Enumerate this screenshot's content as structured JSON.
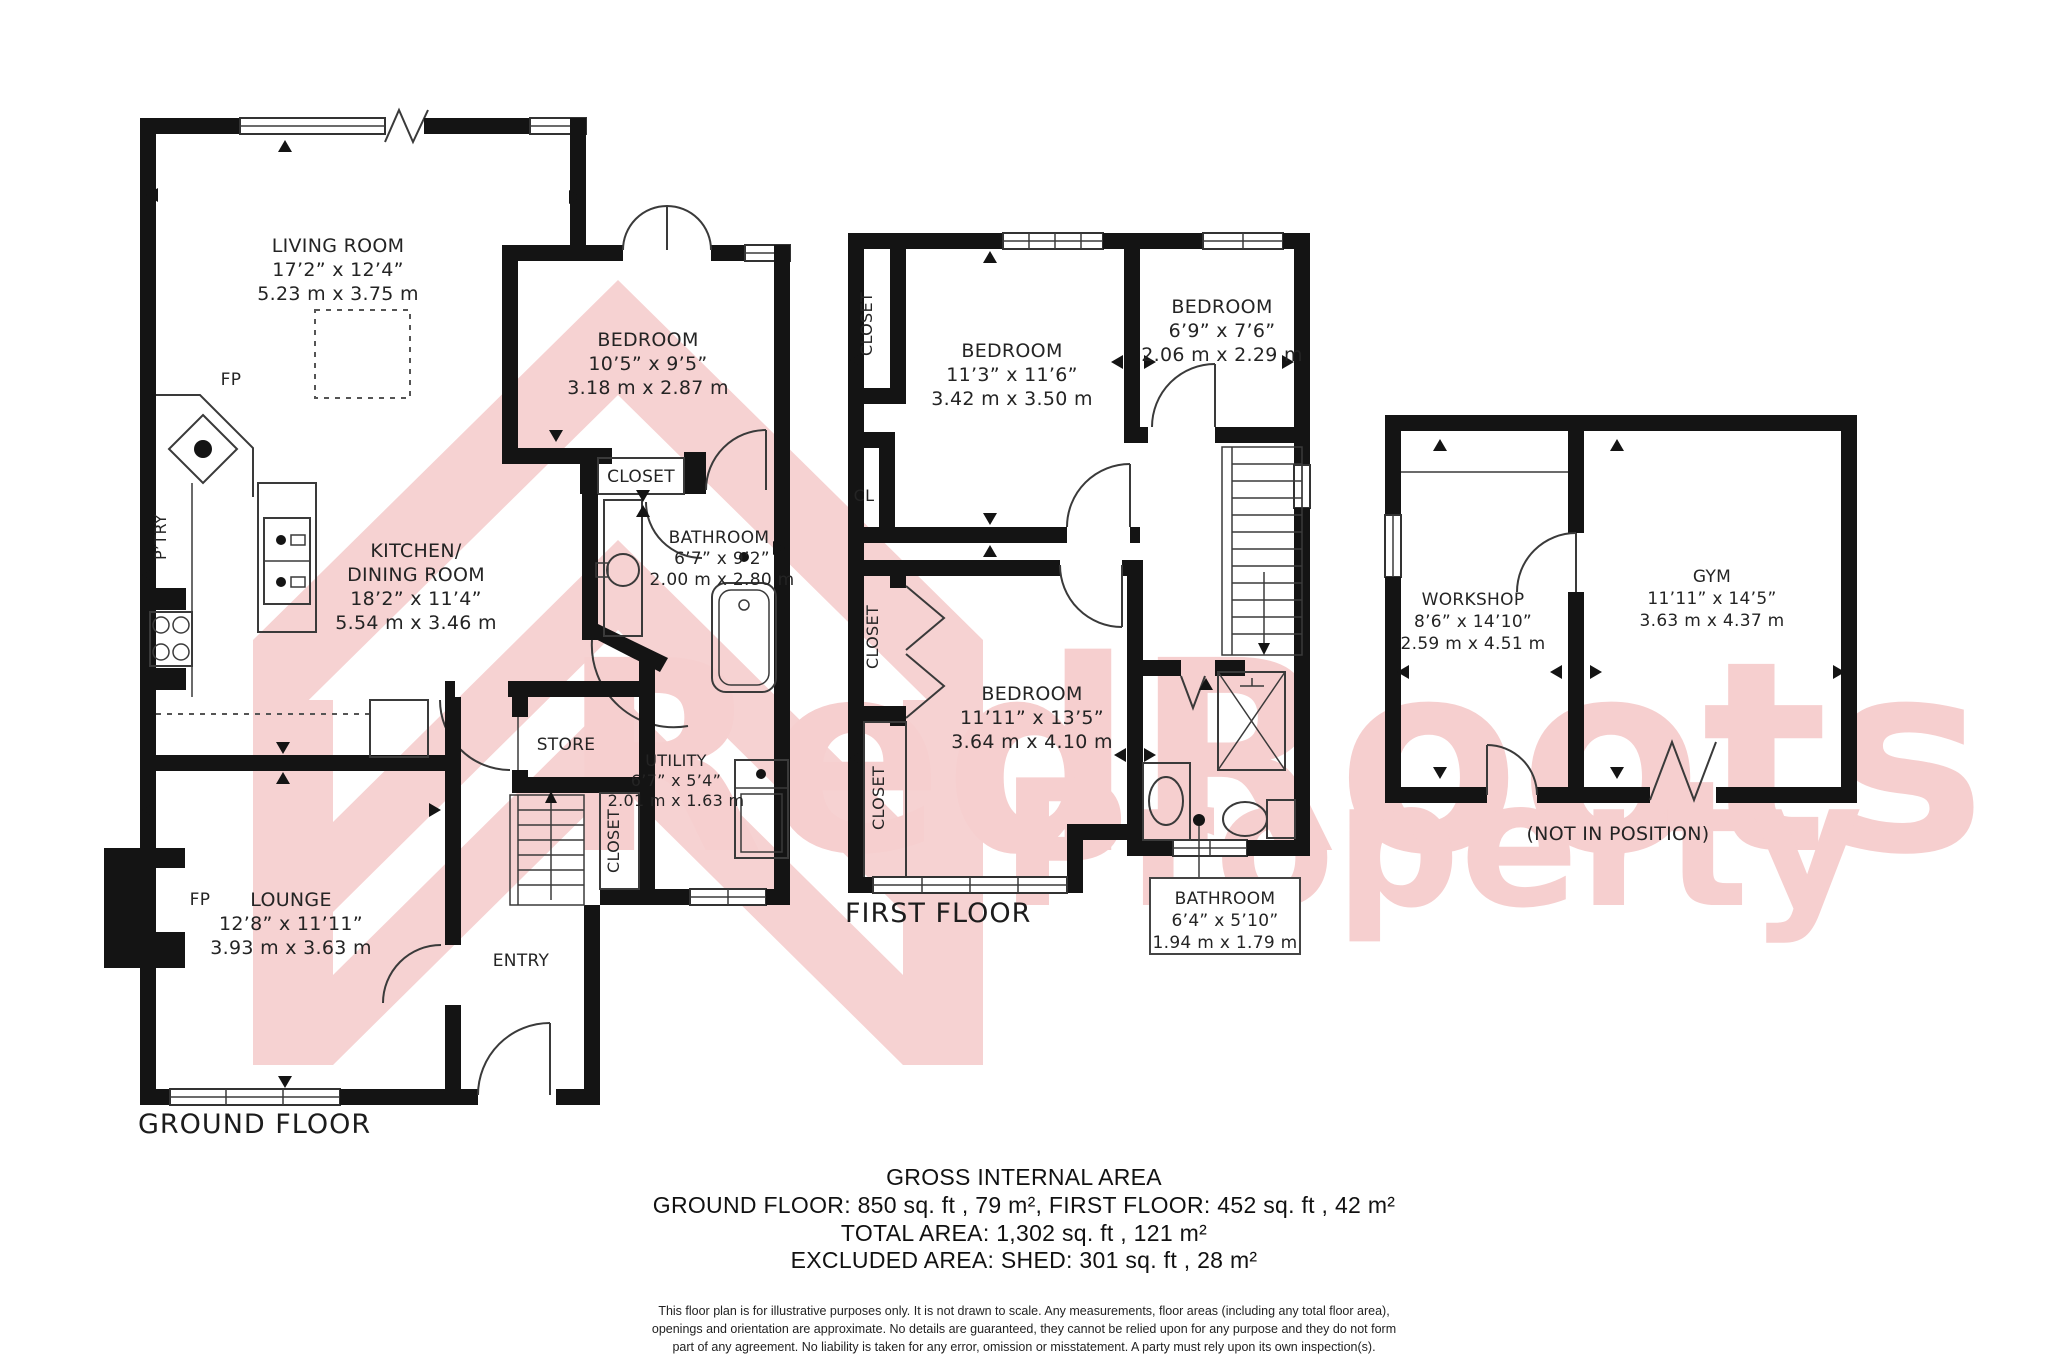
{
  "watermark": {
    "line1": "RedRoots",
    "line2": "Property",
    "color": "#f6cfcf"
  },
  "ground_floor": {
    "title": "GROUND FLOOR",
    "rooms": {
      "living_room": {
        "name": "LIVING ROOM",
        "imperial": "17’2” x 12’4”",
        "metric": "5.23 m x 3.75 m"
      },
      "kitchen": {
        "name1": "KITCHEN/",
        "name2": "DINING ROOM",
        "imperial": "18’2” x 11’4”",
        "metric": "5.54 m x 3.46 m"
      },
      "bedroom": {
        "name": "BEDROOM",
        "imperial": "10’5” x 9’5”",
        "metric": "3.18 m x 2.87 m"
      },
      "bathroom": {
        "name": "BATHROOM",
        "imperial": "6’7” x 9’2”",
        "metric": "2.00 m x 2.80 m"
      },
      "utility": {
        "name": "UTILITY",
        "imperial": "6’7” x 5’4”",
        "metric": "2.01 m x 1.63 m"
      },
      "lounge": {
        "name": "LOUNGE",
        "imperial": "12’8” x 11’11”",
        "metric": "3.93 m x 3.63 m"
      },
      "store": "STORE",
      "entry": "ENTRY",
      "closet": "CLOSET",
      "closet_entry": "CLOSET",
      "pantry": "P’TRY",
      "fireplace1": "FP",
      "fireplace2": "FP"
    }
  },
  "first_floor": {
    "title": "FIRST FLOOR",
    "rooms": {
      "bedroom1": {
        "name": "BEDROOM",
        "imperial": "11’3” x 11’6”",
        "metric": "3.42 m x 3.50 m"
      },
      "bedroom2": {
        "name": "BEDROOM",
        "imperial": "6’9” x 7’6”",
        "metric": "2.06 m x 2.29 m"
      },
      "bedroom3": {
        "name": "BEDROOM",
        "imperial": "11’11” x 13’5”",
        "metric": "3.64 m x 4.10 m"
      },
      "bathroom": {
        "name": "BATHROOM",
        "imperial": "6’4” x 5’10”",
        "metric": "1.94 m x 1.79 m"
      },
      "closet_top": "CLOSET",
      "closet_mid": "CLOSET",
      "closet_bottom": "CLOSET",
      "cl": "CL"
    }
  },
  "outbuilding": {
    "note": "(NOT IN POSITION)",
    "rooms": {
      "workshop": {
        "name": "WORKSHOP",
        "imperial": "8’6” x 14’10”",
        "metric": "2.59 m x 4.51 m"
      },
      "gym": {
        "name": "GYM",
        "imperial": "11’11” x 14’5”",
        "metric": "3.63 m x 4.37 m"
      }
    }
  },
  "footer": {
    "heading": "GROSS INTERNAL AREA",
    "line1": "GROUND FLOOR: 850 sq. ft , 79 m², FIRST FLOOR: 452 sq. ft , 42 m²",
    "line2": "TOTAL AREA: 1,302 sq. ft , 121 m²",
    "line3": "EXCLUDED AREA: SHED: 301 sq. ft , 28 m²",
    "disclaimer1": "This floor plan is for illustrative purposes only. It is not drawn to scale. Any measurements, floor areas (including any total floor area),",
    "disclaimer2": "openings and orientation are approximate. No details are guaranteed, they cannot be relied upon for any purpose and they do not form",
    "disclaimer3": "part of any agreement. No liability is taken for any error, omission or misstatement. A party must rely upon its own inspection(s)."
  }
}
